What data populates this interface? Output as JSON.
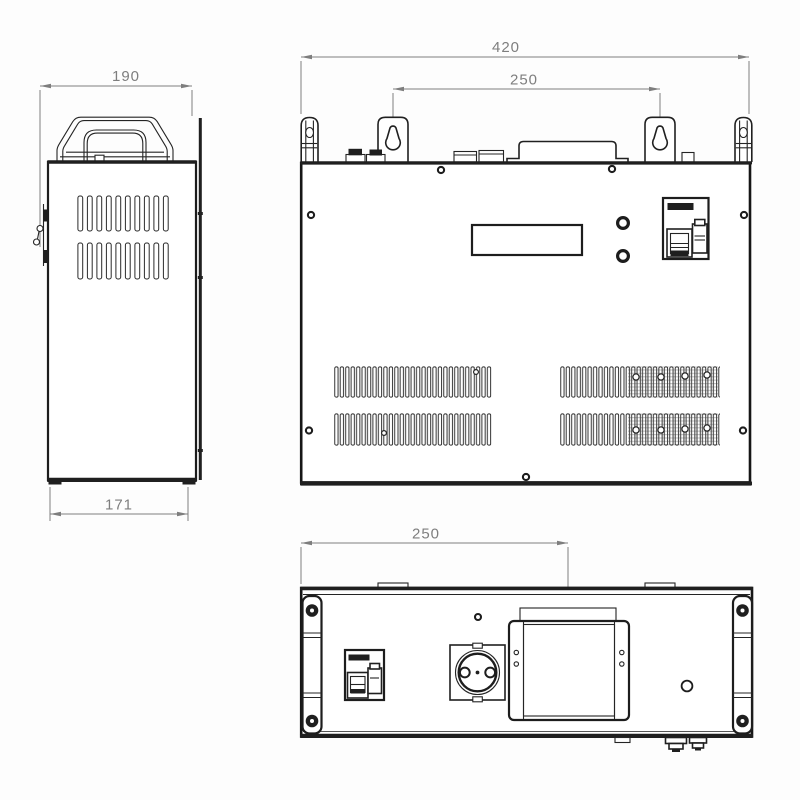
{
  "colors": {
    "background": "#fdfdfd",
    "line": "#1d1d1d",
    "dimension": "#7e7e7e"
  },
  "dimensions": {
    "side_view": {
      "top_width": "190",
      "bottom_width": "171"
    },
    "front_view": {
      "overall_width": "420",
      "mount_hole_spacing": "250"
    },
    "bottom_view": {
      "cover_center_offset": "250"
    }
  }
}
